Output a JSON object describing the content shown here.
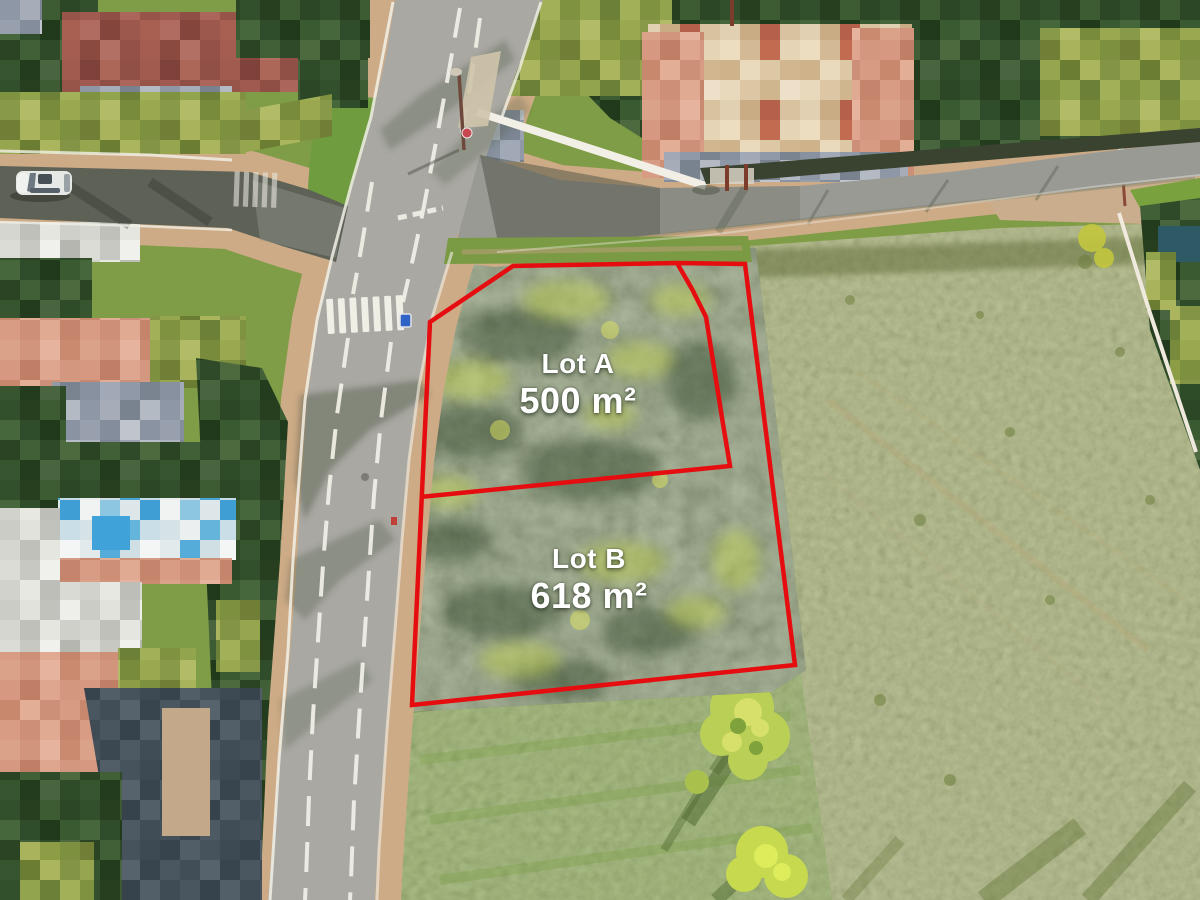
{
  "scene": {
    "kind": "aerial drone photo",
    "subject": "two vacant building lots outlined in red beside a road intersection; neighbouring houses and gardens pixelated for privacy"
  },
  "lots": [
    {
      "name": "Lot A",
      "area": "500 m²"
    },
    {
      "name": "Lot B",
      "area": "618 m²"
    }
  ],
  "boundary": {
    "color": "#e60d10",
    "outer_points": "430,322 513,266 676,263 745,264 795,665 412,705",
    "divider_points": "677,263 692,289 706,317 723,424 730,466 420,497"
  }
}
